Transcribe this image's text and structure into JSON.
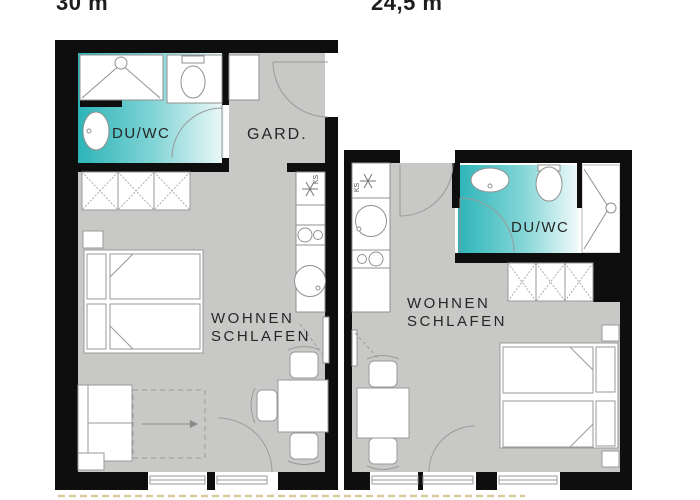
{
  "plan": {
    "title_left": "30 m",
    "title_right": "24,5 m",
    "left": {
      "bath": "DU/WC",
      "wardrobe": "GARD.",
      "living1": "WOHNEN",
      "living2": "SCHLAFEN",
      "fridge": "KS"
    },
    "right": {
      "bath": "DU/WC",
      "living1": "WOHNEN",
      "living2": "SCHLAFEN",
      "fridge": "KS"
    },
    "colors": {
      "wall": "#0e0e0e",
      "floor_gray": "#c8c9c7",
      "teal_dark": "#2db4b8",
      "teal_light": "#edf8f8",
      "outline": "#909090",
      "terrace_line": "#d9c99e"
    }
  }
}
